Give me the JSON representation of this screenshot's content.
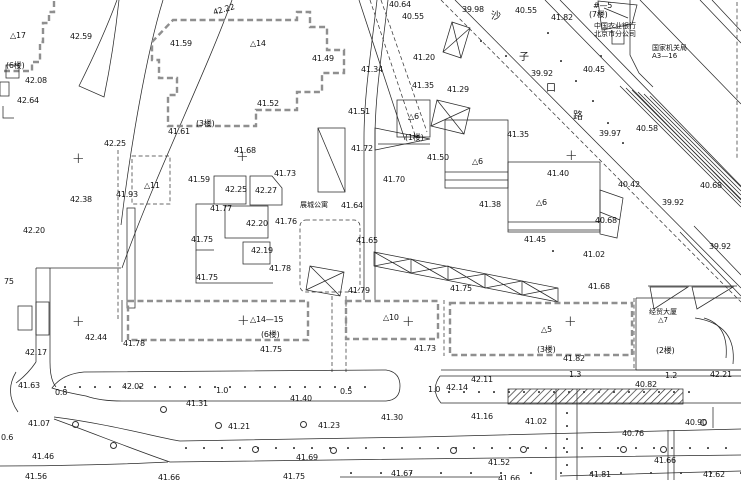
{
  "map": {
    "kind": "topographic-site-plan",
    "colors": {
      "background": "#ffffff",
      "line": "#2a2a2a",
      "dashed_building": "#8f8f8f"
    },
    "road_name_chars": [
      {
        "t": "沙",
        "x": 491,
        "y": 12
      },
      {
        "t": "子",
        "x": 519,
        "y": 53
      },
      {
        "t": "口",
        "x": 546,
        "y": 84
      },
      {
        "t": "路",
        "x": 573,
        "y": 112
      }
    ],
    "annotations": {
      "bank": {
        "line1": "中国农业银行",
        "line2": "北京市分公司"
      },
      "gov": {
        "line1": "国家机关局",
        "line2": "A3—16"
      },
      "apartment": {
        "name": "展城公寓"
      },
      "plaza": {
        "line1": "经贸大厦",
        "line2": "△7"
      }
    },
    "grid_crosses": [
      {
        "x": 77,
        "y": 160
      },
      {
        "x": 241,
        "y": 158
      },
      {
        "x": 570,
        "y": 157
      },
      {
        "x": 77,
        "y": 323
      },
      {
        "x": 242,
        "y": 322
      },
      {
        "x": 407,
        "y": 323
      },
      {
        "x": 569,
        "y": 323
      }
    ],
    "building_labels": [
      {
        "t": "△17",
        "x": 10,
        "y": 32
      },
      {
        "t": "△14",
        "x": 250,
        "y": 40
      },
      {
        "t": "(6楼)",
        "x": 6,
        "y": 62
      },
      {
        "t": "(3楼)",
        "x": 196,
        "y": 120
      },
      {
        "t": "△11",
        "x": 144,
        "y": 182
      },
      {
        "t": "(1楼)",
        "x": 405,
        "y": 134
      },
      {
        "t": "△6",
        "x": 408,
        "y": 113
      },
      {
        "t": "△6",
        "x": 472,
        "y": 158
      },
      {
        "t": "△6",
        "x": 536,
        "y": 199
      },
      {
        "t": "△14—15",
        "x": 250,
        "y": 316
      },
      {
        "t": "(6楼)",
        "x": 261,
        "y": 331
      },
      {
        "t": "△10",
        "x": 383,
        "y": 314
      },
      {
        "t": "△5",
        "x": 541,
        "y": 326
      },
      {
        "t": "(3楼)",
        "x": 537,
        "y": 346
      },
      {
        "t": "(2楼)",
        "x": 656,
        "y": 347
      },
      {
        "t": "#—5",
        "x": 593,
        "y": 2
      },
      {
        "t": "(7楼)",
        "x": 589,
        "y": 11
      }
    ],
    "spot_elevations": [
      {
        "t": "42.22",
        "x": 213,
        "y": 6,
        "r": 1
      },
      {
        "t": "42.59",
        "x": 70,
        "y": 33
      },
      {
        "t": "41.59",
        "x": 170,
        "y": 40
      },
      {
        "t": "42.08",
        "x": 25,
        "y": 77
      },
      {
        "t": "42.64",
        "x": 17,
        "y": 97
      },
      {
        "t": "42.25",
        "x": 104,
        "y": 140
      },
      {
        "t": "41.61",
        "x": 168,
        "y": 128
      },
      {
        "t": "41.49",
        "x": 312,
        "y": 55
      },
      {
        "t": "40.64",
        "x": 389,
        "y": 1
      },
      {
        "t": "40.55",
        "x": 402,
        "y": 13
      },
      {
        "t": "39.98",
        "x": 462,
        "y": 6
      },
      {
        "t": "41.34",
        "x": 361,
        "y": 66
      },
      {
        "t": "41.20",
        "x": 413,
        "y": 54
      },
      {
        "t": "41.52",
        "x": 257,
        "y": 100
      },
      {
        "t": "41.51",
        "x": 348,
        "y": 108
      },
      {
        "t": "41.35",
        "x": 412,
        "y": 82
      },
      {
        "t": "41.29",
        "x": 447,
        "y": 86
      },
      {
        "t": "41.72",
        "x": 351,
        "y": 145
      },
      {
        "t": "41.50",
        "x": 427,
        "y": 154
      },
      {
        "t": "40.55",
        "x": 515,
        "y": 7
      },
      {
        "t": "41.82",
        "x": 551,
        "y": 14
      },
      {
        "t": "39.92",
        "x": 531,
        "y": 70
      },
      {
        "t": "40.45",
        "x": 583,
        "y": 66
      },
      {
        "t": "40.58",
        "x": 636,
        "y": 125
      },
      {
        "t": "39.97",
        "x": 599,
        "y": 130
      },
      {
        "t": "41.35",
        "x": 507,
        "y": 131
      },
      {
        "t": "40.42",
        "x": 618,
        "y": 181
      },
      {
        "t": "40.68",
        "x": 700,
        "y": 182
      },
      {
        "t": "39.92",
        "x": 662,
        "y": 199
      },
      {
        "t": "39.92",
        "x": 709,
        "y": 243
      },
      {
        "t": "40.68",
        "x": 595,
        "y": 217
      },
      {
        "t": "41.02",
        "x": 583,
        "y": 251
      },
      {
        "t": "41.68",
        "x": 588,
        "y": 283
      },
      {
        "t": "42.38",
        "x": 70,
        "y": 196
      },
      {
        "t": "42.20",
        "x": 23,
        "y": 227
      },
      {
        "t": "41.93",
        "x": 116,
        "y": 191
      },
      {
        "t": "41.59",
        "x": 188,
        "y": 176
      },
      {
        "t": "42.25",
        "x": 225,
        "y": 186
      },
      {
        "t": "42.27",
        "x": 255,
        "y": 187
      },
      {
        "t": "41.73",
        "x": 274,
        "y": 170
      },
      {
        "t": "41.68",
        "x": 234,
        "y": 147
      },
      {
        "t": "41.77",
        "x": 210,
        "y": 205
      },
      {
        "t": "42.20",
        "x": 246,
        "y": 220
      },
      {
        "t": "41.76",
        "x": 275,
        "y": 218
      },
      {
        "t": "41.75",
        "x": 191,
        "y": 236
      },
      {
        "t": "42.19",
        "x": 251,
        "y": 247
      },
      {
        "t": "41.78",
        "x": 269,
        "y": 265
      },
      {
        "t": "41.75",
        "x": 196,
        "y": 274
      },
      {
        "t": "41.64",
        "x": 341,
        "y": 202
      },
      {
        "t": "41.65",
        "x": 356,
        "y": 237
      },
      {
        "t": "41.70",
        "x": 383,
        "y": 176
      },
      {
        "t": "41.40",
        "x": 547,
        "y": 170
      },
      {
        "t": "41.38",
        "x": 479,
        "y": 201
      },
      {
        "t": "41.45",
        "x": 524,
        "y": 236
      },
      {
        "t": "41.79",
        "x": 348,
        "y": 287
      },
      {
        "t": "41.75",
        "x": 450,
        "y": 285
      },
      {
        "t": "41.75",
        "x": 260,
        "y": 346
      },
      {
        "t": "41.73",
        "x": 414,
        "y": 345
      },
      {
        "t": "41.82",
        "x": 563,
        "y": 355
      },
      {
        "t": "42.21",
        "x": 710,
        "y": 371
      },
      {
        "t": "1.3",
        "x": 569,
        "y": 371
      },
      {
        "t": "1.2",
        "x": 665,
        "y": 372
      },
      {
        "t": "40.82",
        "x": 635,
        "y": 381
      },
      {
        "t": "42.14",
        "x": 446,
        "y": 384
      },
      {
        "t": "42.11",
        "x": 471,
        "y": 376
      },
      {
        "t": "1.0",
        "x": 428,
        "y": 386
      },
      {
        "t": "0.5",
        "x": 340,
        "y": 388
      },
      {
        "t": "1.0",
        "x": 216,
        "y": 387
      },
      {
        "t": "0.8",
        "x": 55,
        "y": 389
      },
      {
        "t": "42.02",
        "x": 122,
        "y": 383
      },
      {
        "t": "41.63",
        "x": 18,
        "y": 382
      },
      {
        "t": "42.44",
        "x": 85,
        "y": 334
      },
      {
        "t": "42.17",
        "x": 25,
        "y": 349
      },
      {
        "t": "41.78",
        "x": 123,
        "y": 340
      },
      {
        "t": "41.31",
        "x": 186,
        "y": 400
      },
      {
        "t": "41.40",
        "x": 290,
        "y": 395
      },
      {
        "t": "41.30",
        "x": 381,
        "y": 414
      },
      {
        "t": "41.16",
        "x": 471,
        "y": 413
      },
      {
        "t": "41.07",
        "x": 28,
        "y": 420
      },
      {
        "t": "41.21",
        "x": 228,
        "y": 423
      },
      {
        "t": "41.23",
        "x": 318,
        "y": 422
      },
      {
        "t": "0.6",
        "x": 1,
        "y": 434
      },
      {
        "t": "41.46",
        "x": 32,
        "y": 453
      },
      {
        "t": "41.69",
        "x": 296,
        "y": 454
      },
      {
        "t": "41.56",
        "x": 25,
        "y": 473
      },
      {
        "t": "41.66",
        "x": 158,
        "y": 474
      },
      {
        "t": "41.75",
        "x": 283,
        "y": 473
      },
      {
        "t": "41.67",
        "x": 391,
        "y": 470
      },
      {
        "t": "41.66",
        "x": 498,
        "y": 475
      },
      {
        "t": "41.02",
        "x": 525,
        "y": 418
      },
      {
        "t": "40.90",
        "x": 685,
        "y": 419
      },
      {
        "t": "40.76",
        "x": 622,
        "y": 430
      },
      {
        "t": "41.52",
        "x": 488,
        "y": 459
      },
      {
        "t": "41.66",
        "x": 654,
        "y": 457
      },
      {
        "t": "41.81",
        "x": 589,
        "y": 471
      },
      {
        "t": "41.62",
        "x": 703,
        "y": 471
      },
      {
        "t": "75",
        "x": 4,
        "y": 278
      }
    ]
  }
}
